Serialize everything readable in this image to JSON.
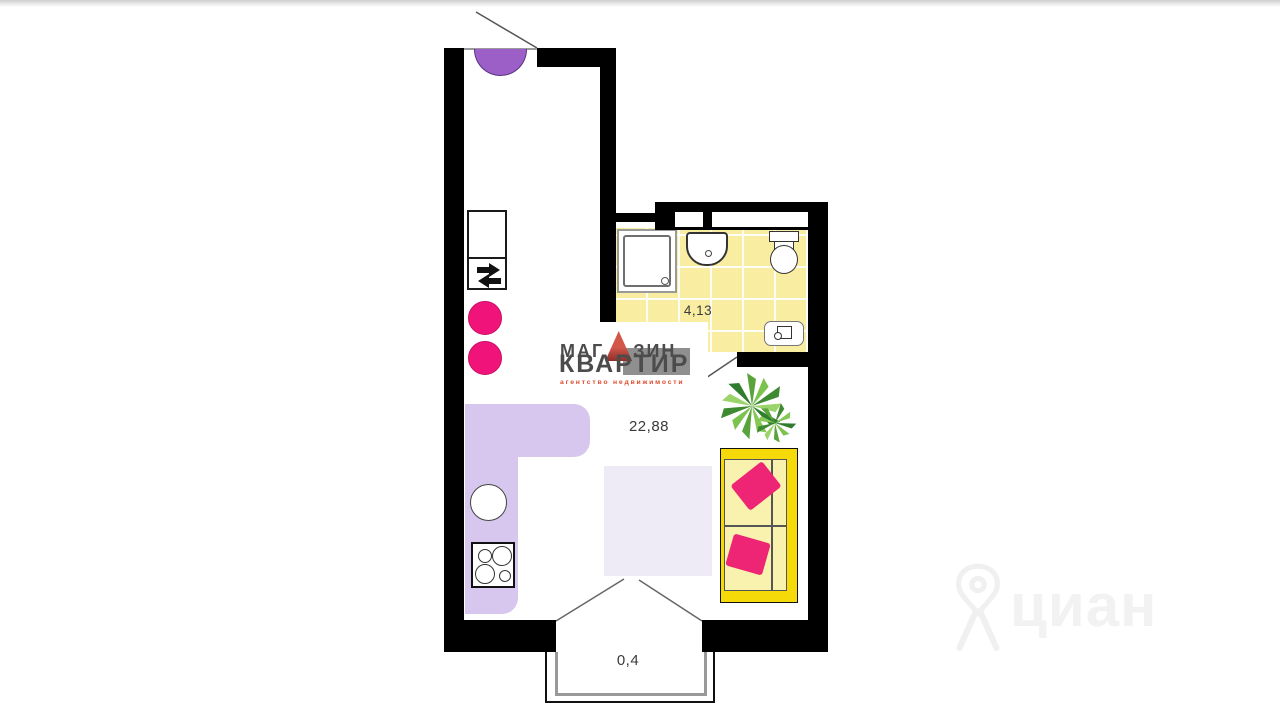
{
  "plan": {
    "rooms": {
      "main": {
        "name": "living room / kitchen",
        "area": "22,88"
      },
      "bathroom": {
        "name": "bathroom",
        "area": "4,13"
      },
      "balcony": {
        "name": "balcony",
        "area": "0,4"
      }
    },
    "colors": {
      "wall": "#000000",
      "bathroom_floor": "#f8eda1",
      "kitchen_counter": "#d7c7ee",
      "carpet": "#eeeaf6",
      "door_arc": "#9c5ec7",
      "stool": "#f0147a",
      "sofa_frame": "#f5d908",
      "sofa_seat": "#f9f2af",
      "pillow": "#ee2474"
    }
  },
  "watermarks": {
    "agency": {
      "line1_pre": "МАГ",
      "line1_post": "ЗИН",
      "line2": "КВАРТИР",
      "line3": "агентство недвижимости"
    },
    "cian": {
      "text": "циан"
    }
  }
}
